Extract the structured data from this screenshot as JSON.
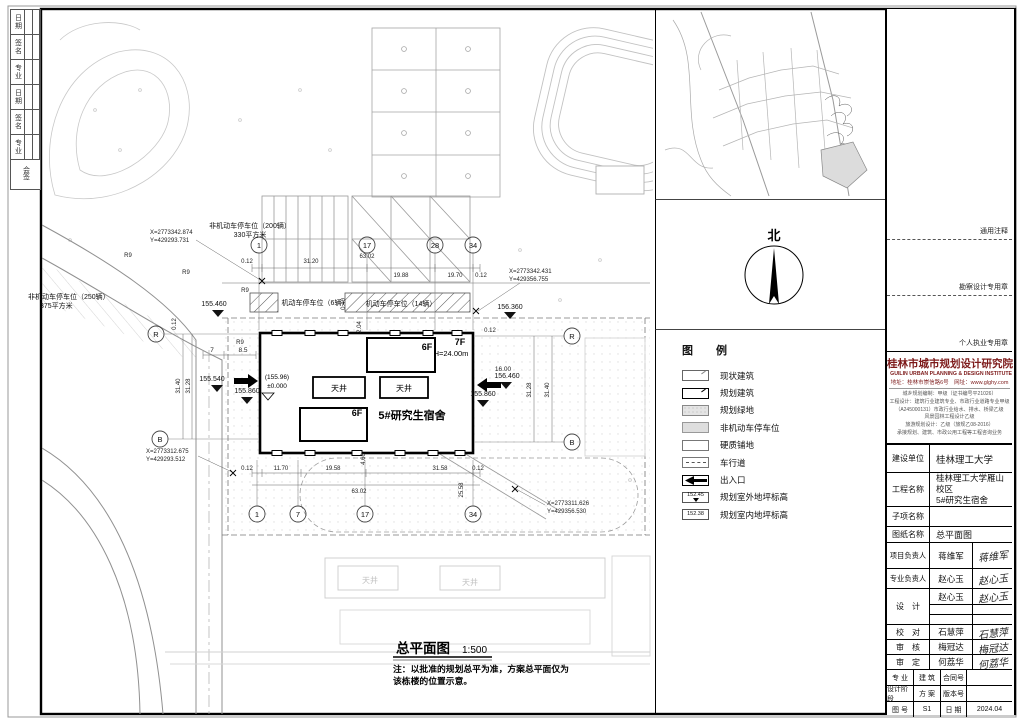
{
  "plan": {
    "title": "总平面图",
    "scale": "1:500",
    "note1": "注：以批准的规划总平为准，方案总平面仅为",
    "note2": "该栋楼的位置示意。",
    "building": {
      "name": "5#研究生宿舍",
      "floors_a": "6F",
      "floors_b": "6F",
      "tower_floors": "7F",
      "height": "H=24.00m",
      "level": "(155.96)",
      "zero": "±0.000",
      "court1": "天井",
      "court2": "天井",
      "faint_court": "天井"
    },
    "parking": {
      "bike200_1": "非机动车停车位（200辆）",
      "bike200_2": "330平方米",
      "bike250_1": "非机动车停车位（250辆）",
      "bike250_2": "375平方米",
      "car6": "机动车停车位（6辆）",
      "car14": "机动车停车位（14辆）"
    },
    "coords": [
      {
        "x": "X=2773342.874",
        "y": "Y=429293.731"
      },
      {
        "x": "X=2773342.431",
        "y": "Y=429356.755"
      },
      {
        "x": "X=2773312.675",
        "y": "Y=429293.512"
      },
      {
        "x": "X=2773311.626",
        "y": "Y=429356.530"
      }
    ],
    "levels": {
      "l1": "155.460",
      "l2": "155.540",
      "l3": "155.860",
      "l4": "156.360",
      "l5": "156.460",
      "l6": "155.860"
    },
    "grid": {
      "n1": "1",
      "n7": "7",
      "n17": "17",
      "n28": "28",
      "n34": "34",
      "lR": "R",
      "lB": "B"
    },
    "dims": {
      "d012": "0.12",
      "d3120": "31.20",
      "d6302": "63.02",
      "d1988": "19.88",
      "d1970": "19.70",
      "d1170": "11.70",
      "d1958": "19.58",
      "d3158": "31.58",
      "d2558": "25.58",
      "d1600": "16.00",
      "d3140": "31.40",
      "d3128": "31.28",
      "d7": "7",
      "d85": "8.5",
      "r9": "R9",
      "d204": "2.04",
      "d460": "4.60",
      "d040": "0.40"
    }
  },
  "north": {
    "label": "北"
  },
  "legend": {
    "title": "图 例",
    "items": [
      {
        "label": "现状建筑"
      },
      {
        "label": "规划建筑"
      },
      {
        "label": "规划绿地"
      },
      {
        "label": "非机动车停车位"
      },
      {
        "label": "硬质铺地"
      },
      {
        "label": "车行道"
      },
      {
        "label": "出入口"
      },
      {
        "label": "规划室外地坪标高",
        "value": "152.45"
      },
      {
        "label": "规划室内地坪标高",
        "value": "152.38"
      }
    ]
  },
  "stamps": {
    "s1": "通用注释",
    "s2": "勘察设计专用章",
    "s3": "个人执业专用章"
  },
  "institute": {
    "name_cn": "桂林市城市规划设计研究院",
    "name_en": "GUILIN URBAN PLANNING & DESIGN INSTITUTE",
    "address": "地址：桂林市崇信路6号　网址：www.glghy.com",
    "credentials": [
      "城乡规划编制：甲级（证书编号平21026）",
      "工程设计：建筑行业建筑专业、市政行业道路专业甲级",
      "（A245000131）市政行业给水、排水、桥梁乙级",
      "风景园林工程设计乙级",
      "旅游规划设计：乙级（旅规乙08-2016）",
      "承接规划、建筑、市政公用工程等工程咨询业务"
    ]
  },
  "titleblock": {
    "rows": {
      "owner_label": "建设单位",
      "owner": "桂林理工大学",
      "project_label": "工程名称",
      "project1": "桂林理工大学雁山校区",
      "project2": "5#研究生宿舍",
      "subitem_label": "子项名称",
      "subitem": "",
      "drawing_label": "图纸名称",
      "drawing": "总平面图",
      "pm_label": "项目负责人",
      "pm": "蒋维军",
      "pm_sig": "蒋维军",
      "lead_label": "专业负责人",
      "lead": "赵心玉",
      "lead_sig": "赵心玉",
      "design_label": "设　计",
      "designer": "赵心玉",
      "designer_sig": "赵心玉",
      "check_label": "校　对",
      "checker": "石慧萍",
      "checker_sig": "石慧萍",
      "review_label": "审　核",
      "reviewer": "梅冠达",
      "reviewer_sig": "梅冠达",
      "approve_label": "审　定",
      "approver": "何荔华",
      "approver_sig": "何荔华"
    },
    "footer": {
      "spec_label": "专 业",
      "spec": "建 筑",
      "contract_label": "合同号",
      "contract": "",
      "stage_label": "设计阶段",
      "stage": "方 案",
      "version_label": "版本号",
      "version": "",
      "figno_label": "图 号",
      "figno": "S1",
      "date_label": "日 期",
      "date": "2024.04"
    }
  },
  "countersign": {
    "rows": [
      "日期",
      "签名",
      "专业",
      "日期",
      "签名",
      "专业"
    ],
    "footer": "会签"
  }
}
